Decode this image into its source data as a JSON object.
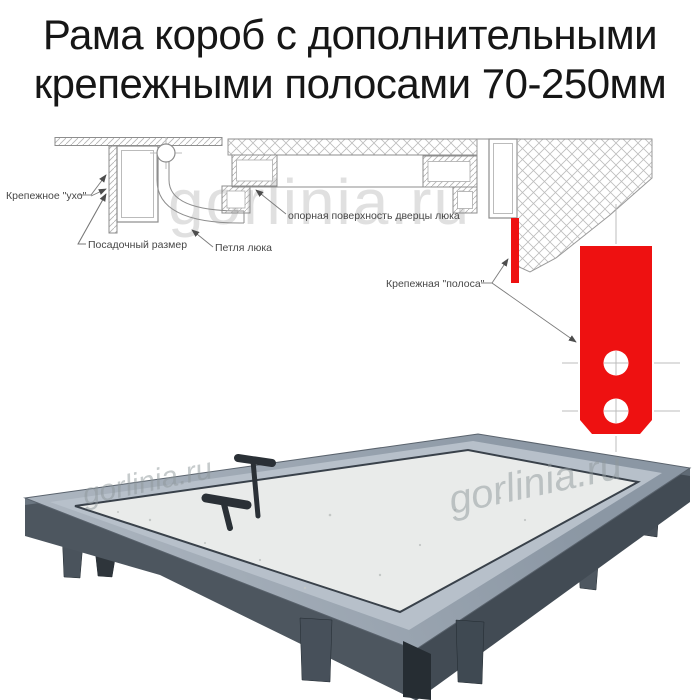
{
  "title": {
    "line1": "Рама короб с дополнительными",
    "line2": "крепежными полосами 70-250мм"
  },
  "watermark": {
    "text": "gorlinia.ru"
  },
  "diagram": {
    "labels": {
      "ear": "Крепежное \"ухо\"",
      "fit_size": "Посадочный размер",
      "hinge": "Петля люка",
      "support": "опорная поверхность дверцы люка",
      "strip": "Крепежная \"полоса\""
    }
  },
  "colors": {
    "red": "#ee1111",
    "frame_grey": "#4d565f",
    "panel": "#e9ebea"
  }
}
